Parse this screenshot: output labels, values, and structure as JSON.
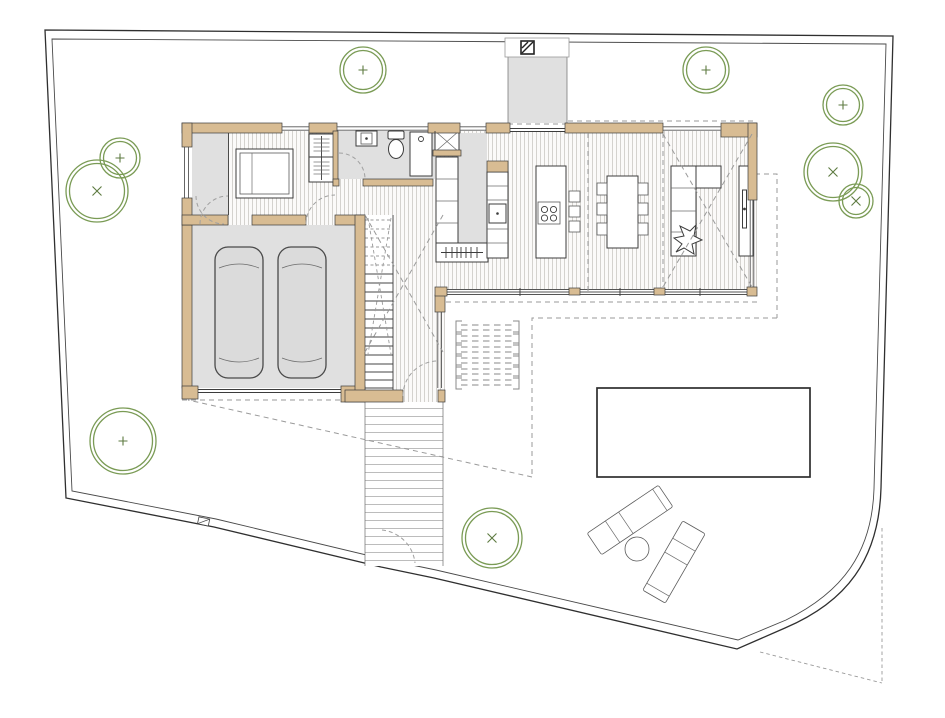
{
  "document": {
    "type": "architectural-floor-plan",
    "view": "ground-floor-with-site-plan",
    "visible_text": []
  },
  "palette": {
    "wall_fill": "#d8bc93",
    "outline": "#3c3c3c",
    "floor_gray": "#e0e0e0",
    "wood_stripe": "#cac8c3",
    "wood_bg": "#fbfaf9",
    "dashed": "#9a9a9a",
    "tree_stroke": "#7a9b55",
    "tree_mark": "#5d7a40",
    "pool_stroke": "#2e2e2e",
    "boundary": "#2f2f2f"
  },
  "site": {
    "boundary_shape": "irregular lot, double fence line, rounded south-east corner with dashed original corner triangle",
    "pool": {
      "x": 597,
      "y": 388,
      "width": 213,
      "height": 89
    },
    "walkway": {
      "x": 365,
      "y": 402,
      "width": 78,
      "height": 164
    },
    "north_path": {
      "x": 508,
      "y": 56,
      "width": 59,
      "height": 67
    },
    "pergola_rows": 6,
    "loungers": 2,
    "side_tables": 1,
    "trees": [
      {
        "x": 363,
        "y": 70,
        "r": 23,
        "mark": "plus"
      },
      {
        "x": 706,
        "y": 70,
        "r": 23,
        "mark": "plus"
      },
      {
        "x": 843,
        "y": 105,
        "r": 20,
        "mark": "plus"
      },
      {
        "x": 833,
        "y": 172,
        "r": 29,
        "mark": "x"
      },
      {
        "x": 856,
        "y": 201,
        "r": 17,
        "mark": "x"
      },
      {
        "x": 120,
        "y": 158,
        "r": 20,
        "mark": "plus"
      },
      {
        "x": 97,
        "y": 191,
        "r": 31,
        "mark": "x"
      },
      {
        "x": 123,
        "y": 441,
        "r": 33,
        "mark": "plus"
      },
      {
        "x": 492,
        "y": 538,
        "r": 30,
        "mark": "x"
      }
    ]
  },
  "house": {
    "rooms": [
      "entry-hall",
      "bedroom",
      "bathroom",
      "entry-niche",
      "kitchen",
      "dining",
      "living",
      "garage",
      "stair-corridor"
    ],
    "garage_cars": 2,
    "kitchen_bar_stools": 3,
    "dining_chairs": 6,
    "cooktop_burners": 4,
    "stair_flight": "straight run, upper treads dashed above section cut"
  }
}
